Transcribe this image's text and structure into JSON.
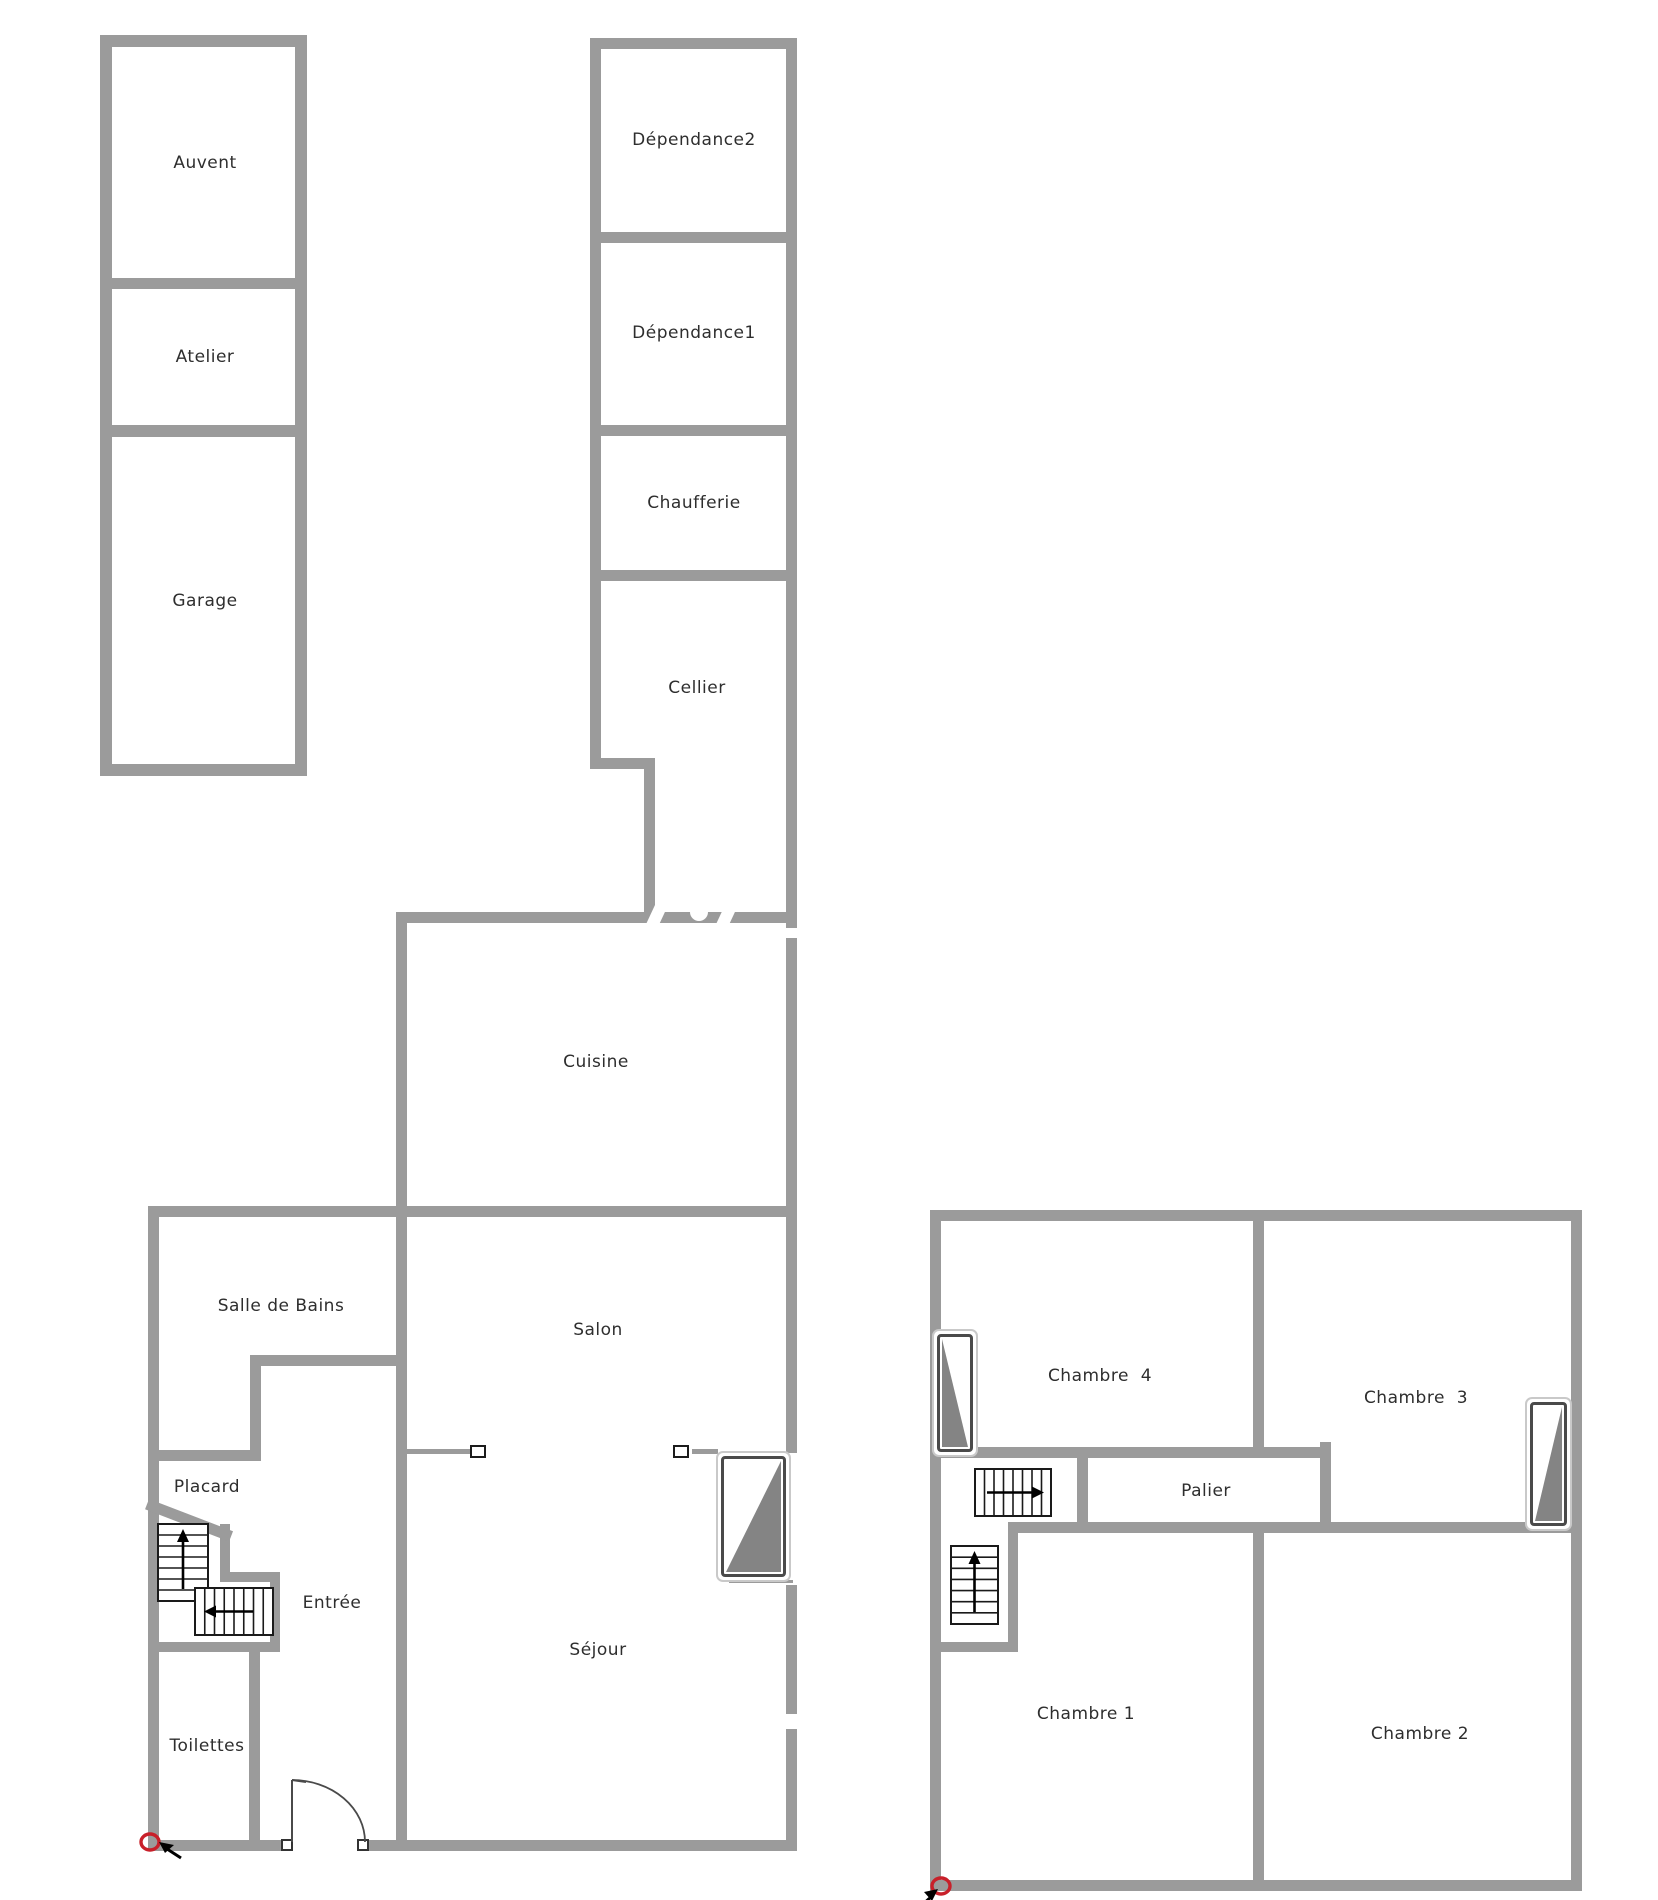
{
  "plan_title": "house floor plan (ground floor and first floor)",
  "colors": {
    "wall": "#9b9b9b",
    "stair_stroke": "#1a1a1a",
    "window_gray": "#848484",
    "marker_red": "#c8202a",
    "text": "#2e2e2e"
  },
  "rooms": [
    {
      "id": "auvent",
      "label": "Auvent"
    },
    {
      "id": "atelier",
      "label": "Atelier"
    },
    {
      "id": "garage",
      "label": "Garage"
    },
    {
      "id": "dependance2",
      "label": "Dépendance2"
    },
    {
      "id": "dependance1",
      "label": "Dépendance1"
    },
    {
      "id": "chaufferie",
      "label": "Chaufferie"
    },
    {
      "id": "cellier",
      "label": "Cellier"
    },
    {
      "id": "cuisine",
      "label": "Cuisine"
    },
    {
      "id": "salle-de-bains",
      "label": "Salle de Bains"
    },
    {
      "id": "salon",
      "label": "Salon"
    },
    {
      "id": "placard",
      "label": "Placard"
    },
    {
      "id": "entree",
      "label": "Entrée"
    },
    {
      "id": "sejour",
      "label": "Séjour"
    },
    {
      "id": "toilettes",
      "label": "Toilettes"
    },
    {
      "id": "chambre-4",
      "label": "Chambre  4"
    },
    {
      "id": "chambre-3",
      "label": "Chambre  3"
    },
    {
      "id": "palier",
      "label": "Palier"
    },
    {
      "id": "chambre-1",
      "label": "Chambre 1"
    },
    {
      "id": "chambre-2",
      "label": "Chambre 2"
    }
  ],
  "labels": [
    {
      "room": 0,
      "x": 205,
      "y": 163
    },
    {
      "room": 1,
      "x": 205,
      "y": 357
    },
    {
      "room": 2,
      "x": 205,
      "y": 601
    },
    {
      "room": 3,
      "x": 694,
      "y": 140
    },
    {
      "room": 4,
      "x": 694,
      "y": 333
    },
    {
      "room": 5,
      "x": 694,
      "y": 503
    },
    {
      "room": 6,
      "x": 697,
      "y": 688
    },
    {
      "room": 7,
      "x": 596,
      "y": 1062
    },
    {
      "room": 8,
      "x": 281,
      "y": 1306
    },
    {
      "room": 9,
      "x": 598,
      "y": 1330
    },
    {
      "room": 10,
      "x": 207,
      "y": 1487
    },
    {
      "room": 11,
      "x": 332,
      "y": 1603
    },
    {
      "room": 12,
      "x": 598,
      "y": 1650
    },
    {
      "room": 13,
      "x": 207,
      "y": 1746
    },
    {
      "room": 14,
      "x": 1100,
      "y": 1376
    },
    {
      "room": 15,
      "x": 1416,
      "y": 1398
    },
    {
      "room": 16,
      "x": 1206,
      "y": 1491
    },
    {
      "room": 17,
      "x": 1086,
      "y": 1714
    },
    {
      "room": 18,
      "x": 1420,
      "y": 1734
    }
  ],
  "walls": [
    [
      100,
      35,
      207,
      12
    ],
    [
      100,
      35,
      12,
      741
    ],
    [
      295,
      35,
      12,
      741
    ],
    [
      100,
      278,
      207,
      11
    ],
    [
      100,
      425,
      207,
      12
    ],
    [
      100,
      764,
      207,
      12
    ],
    [
      590,
      38,
      207,
      11
    ],
    [
      590,
      38,
      11,
      731
    ],
    [
      786,
      38,
      11,
      890
    ],
    [
      590,
      232,
      207,
      11
    ],
    [
      590,
      425,
      207,
      11
    ],
    [
      590,
      570,
      207,
      11
    ],
    [
      590,
      758,
      65,
      11
    ],
    [
      644,
      758,
      11,
      165
    ],
    [
      786,
      938,
      11,
      515
    ],
    [
      786,
      1585,
      11,
      129
    ],
    [
      786,
      1729,
      11,
      122
    ],
    [
      396,
      912,
      390,
      11
    ],
    [
      396,
      912,
      11,
      939
    ],
    [
      148,
      1206,
      649,
      11
    ],
    [
      148,
      1206,
      11,
      645
    ],
    [
      250,
      1355,
      157,
      11
    ],
    [
      250,
      1355,
      11,
      106
    ],
    [
      148,
      1450,
      110,
      11
    ],
    [
      220,
      1524,
      10,
      57
    ],
    [
      220,
      1572,
      60,
      10
    ],
    [
      270,
      1572,
      10,
      80
    ],
    [
      148,
      1642,
      132,
      10
    ],
    [
      249,
      1650,
      11,
      191
    ],
    [
      148,
      1840,
      138,
      11
    ],
    [
      368,
      1840,
      429,
      11
    ],
    [
      930,
      1210,
      652,
      11
    ],
    [
      930,
      1210,
      11,
      681
    ],
    [
      1571,
      1210,
      11,
      681
    ],
    [
      930,
      1880,
      652,
      11
    ],
    [
      1253,
      1210,
      11,
      248
    ],
    [
      930,
      1447,
      401,
      11
    ],
    [
      1320,
      1442,
      11,
      91
    ],
    [
      1077,
      1447,
      11,
      86
    ],
    [
      1008,
      1522,
      563,
      11
    ],
    [
      1008,
      1522,
      10,
      130
    ],
    [
      930,
      1642,
      88,
      10
    ],
    [
      1253,
      1522,
      11,
      369
    ]
  ],
  "diagonal_wall": {
    "x": 149,
    "y": 1499,
    "len": 90,
    "ang": 21,
    "th": 11
  },
  "thin_lines": [
    [
      407,
      1449,
      65,
      5
    ],
    [
      692,
      1449,
      26,
      5
    ],
    [
      729,
      1580,
      64,
      3
    ]
  ],
  "divider_handles": [
    [
      470,
      1445,
      16,
      13
    ],
    [
      673,
      1445,
      16,
      13
    ]
  ],
  "windows": [
    {
      "x": 716,
      "y": 1451,
      "w": 75,
      "h": 131,
      "tri": "br"
    },
    {
      "x": 932,
      "y": 1329,
      "w": 46,
      "h": 128,
      "tri": "bl"
    },
    {
      "x": 1525,
      "y": 1397,
      "w": 47,
      "h": 134,
      "tri": "br"
    }
  ],
  "stairs": [
    {
      "x": 158,
      "y": 1524,
      "w": 50,
      "h": 77,
      "dir": "v",
      "treads": 6,
      "arrow": "up"
    },
    {
      "x": 195,
      "y": 1588,
      "w": 78,
      "h": 47,
      "dir": "h",
      "treads": 7,
      "arrow": "left"
    },
    {
      "x": 975,
      "y": 1469,
      "w": 76,
      "h": 47,
      "dir": "h",
      "treads": 7,
      "arrow": "right"
    },
    {
      "x": 951,
      "y": 1546,
      "w": 47,
      "h": 78,
      "dir": "v",
      "treads": 6,
      "arrow": "up"
    }
  ],
  "door_arcs": [
    {
      "d": "M 292 1780 A 73 62 0 0 1 365 1842"
    }
  ],
  "door_lines": [
    {
      "x1": 292,
      "y1": 1780,
      "x2": 292,
      "y2": 1842
    },
    {
      "x1": 292,
      "y1": 1780,
      "x2": 306,
      "y2": 1782
    }
  ],
  "door_posts": [
    [
      281,
      1839,
      12,
      12
    ],
    [
      357,
      1839,
      12,
      12
    ]
  ],
  "wall_slashes": [
    [
      650,
      905,
      12,
      24,
      25
    ],
    [
      720,
      905,
      12,
      24,
      25
    ]
  ],
  "wall_notches": [
    [
      690,
      903,
      18
    ]
  ],
  "red_markers": [
    {
      "cx": 150,
      "cy": 1842,
      "rx": 9,
      "ry": 8
    },
    {
      "cx": 941,
      "cy": 1886,
      "rx": 9,
      "ry": 8
    }
  ],
  "cursor_arrows": [
    {
      "line": [
        181,
        1858,
        164,
        1847
      ],
      "head": "159,1842 174,1845 165,1853"
    },
    {
      "line": [
        921,
        1906,
        932,
        1896
      ],
      "head": "938,1889 924,1892 932,1901"
    }
  ]
}
